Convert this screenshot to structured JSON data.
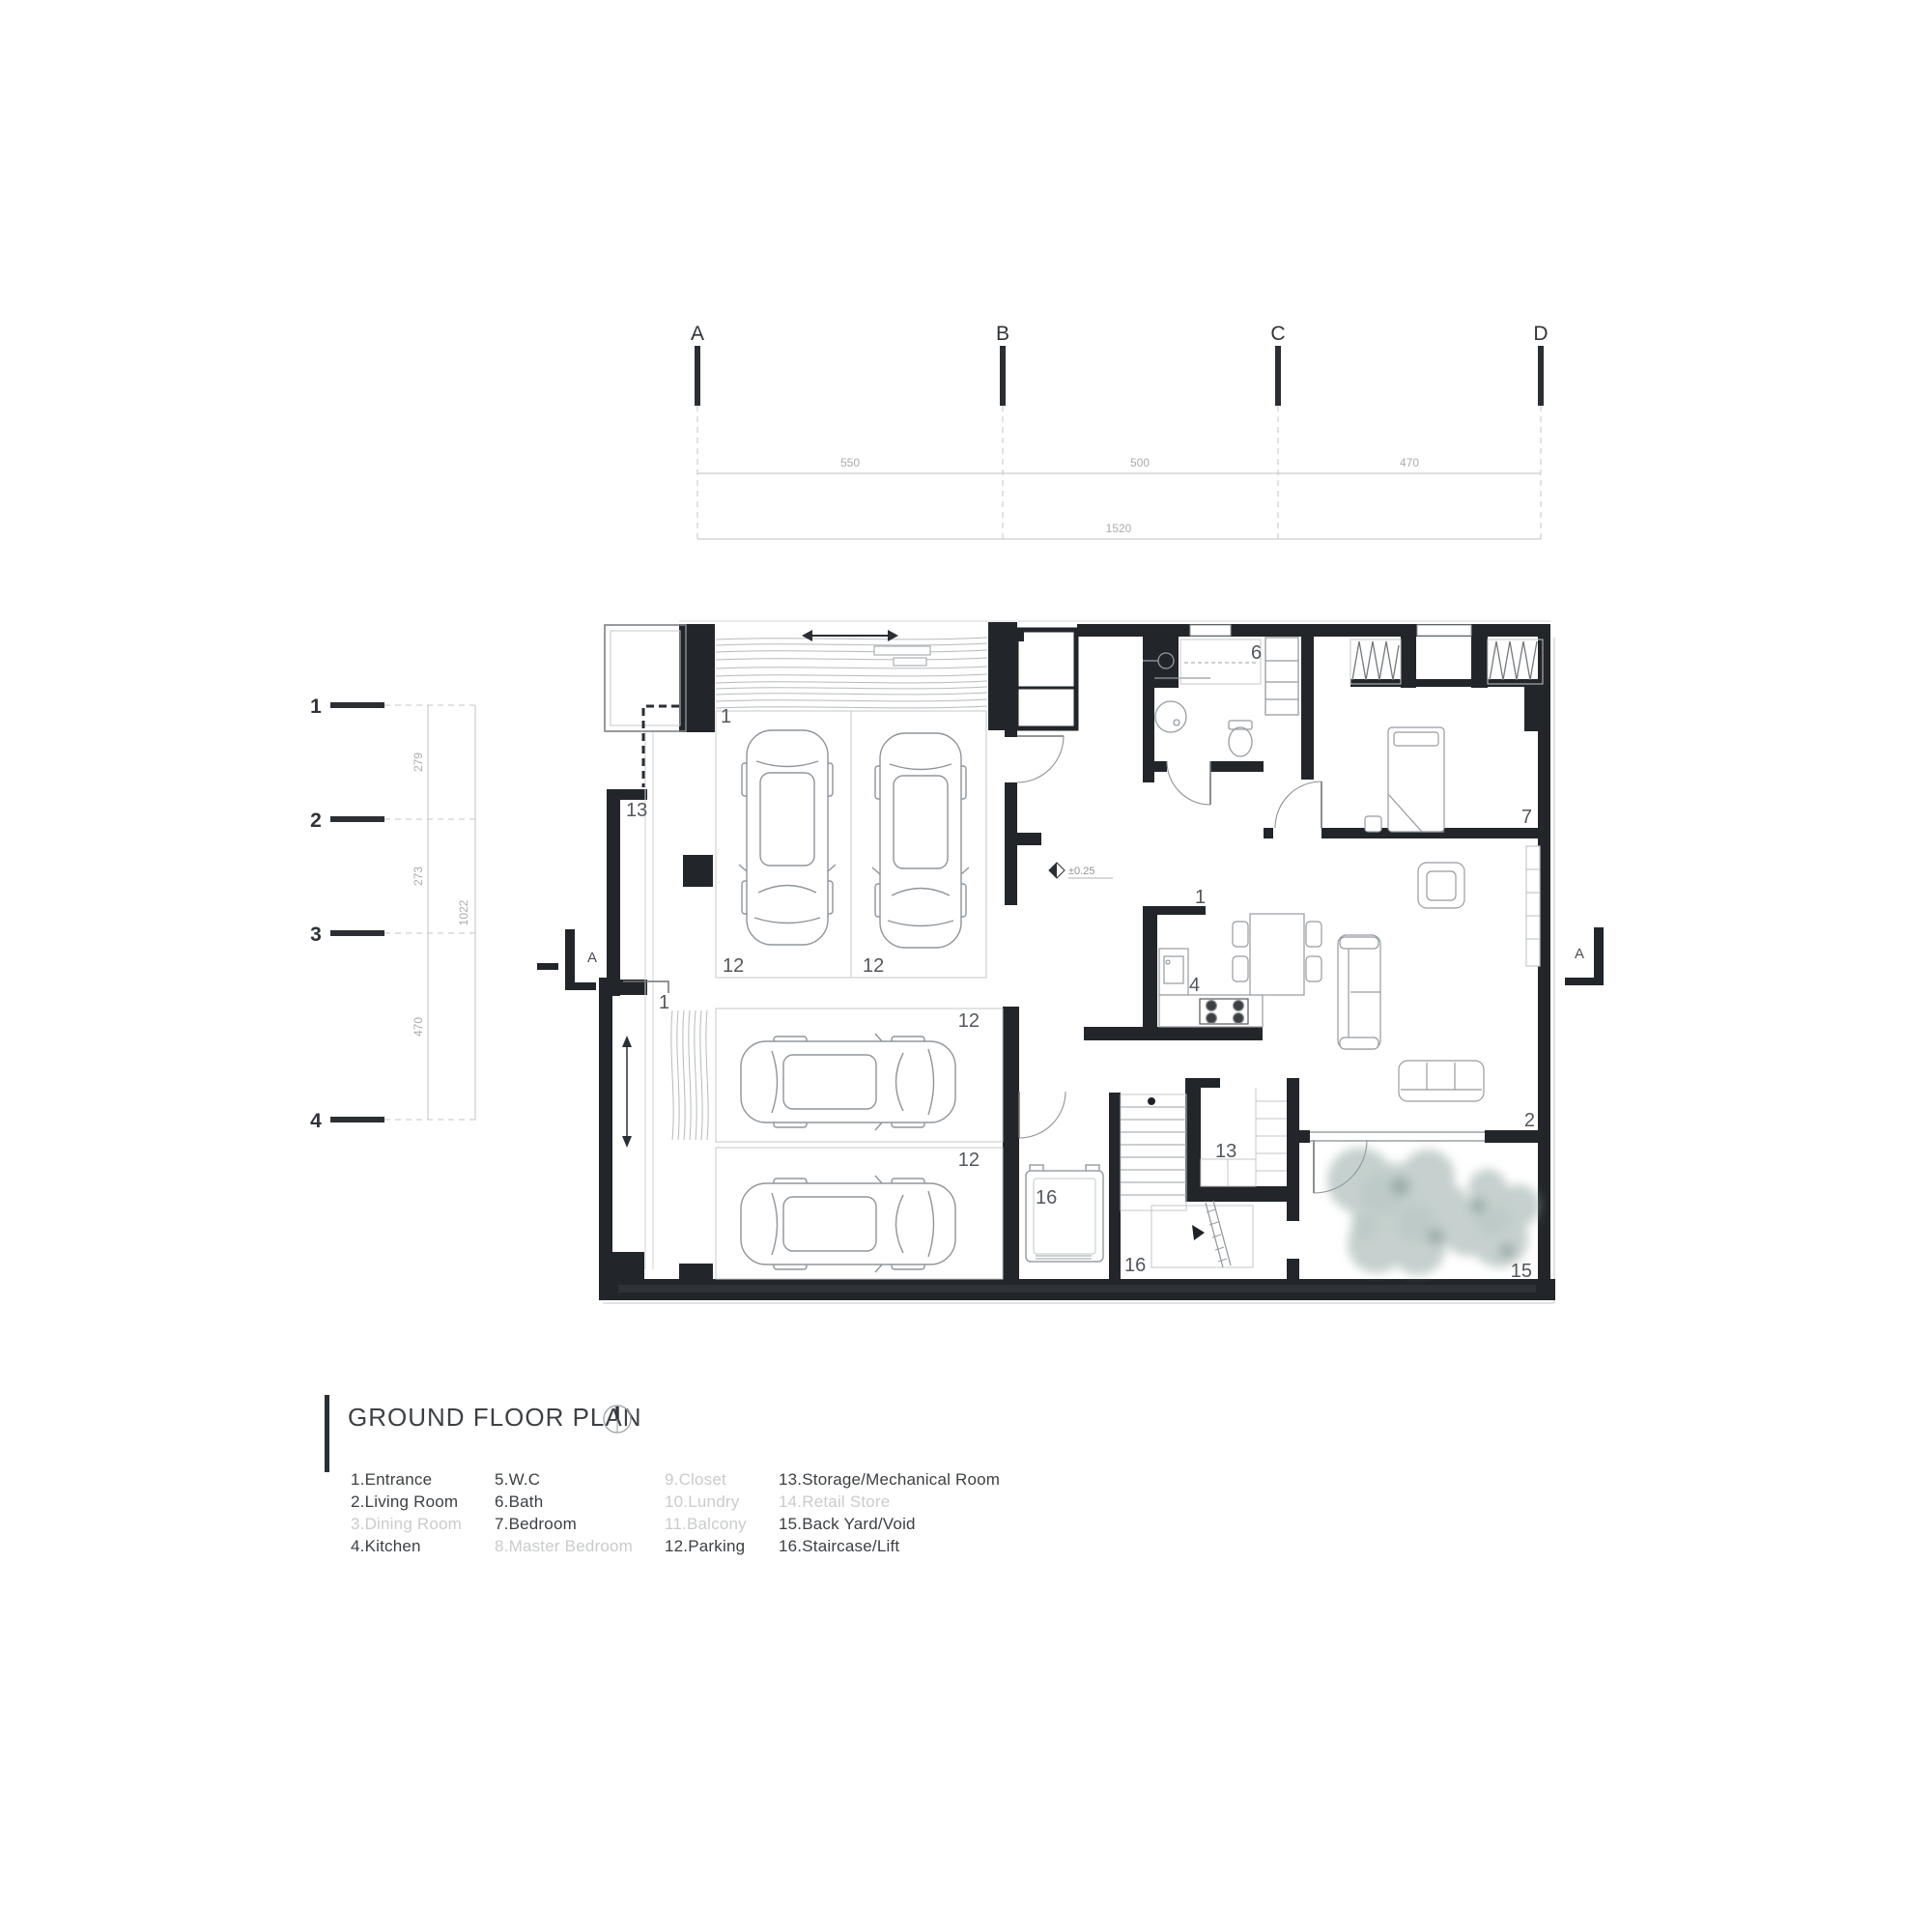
{
  "grid": {
    "columns": [
      {
        "label": "A"
      },
      {
        "label": "B"
      },
      {
        "label": "C"
      },
      {
        "label": "D"
      }
    ],
    "rows": [
      {
        "label": "1"
      },
      {
        "label": "2"
      },
      {
        "label": "3"
      },
      {
        "label": "4"
      }
    ],
    "column_dims": [
      "550",
      "500",
      "470"
    ],
    "column_total": "1520",
    "row_dims": [
      "279",
      "273",
      "470"
    ],
    "row_total": "1022"
  },
  "plan": {
    "level_marker": "±0.25",
    "section_marker_left": "A",
    "section_marker_right": "A",
    "room_labels": [
      {
        "text": "1"
      },
      {
        "text": "12"
      },
      {
        "text": "12"
      },
      {
        "text": "13"
      },
      {
        "text": "1"
      },
      {
        "text": "12"
      },
      {
        "text": "12"
      },
      {
        "text": "6"
      },
      {
        "text": "7"
      },
      {
        "text": "1"
      },
      {
        "text": "4"
      },
      {
        "text": "16"
      },
      {
        "text": "13"
      },
      {
        "text": "16"
      },
      {
        "text": "2"
      },
      {
        "text": "15"
      }
    ]
  },
  "title_block": {
    "title": "GROUND FLOOR PLAN"
  },
  "legend": {
    "items": [
      {
        "label": "1.Entrance",
        "present": true
      },
      {
        "label": "2.Living Room",
        "present": true
      },
      {
        "label": "3.Dining Room",
        "present": false
      },
      {
        "label": "4.Kitchen",
        "present": true
      },
      {
        "label": "5.W.C",
        "present": true
      },
      {
        "label": "6.Bath",
        "present": true
      },
      {
        "label": "7.Bedroom",
        "present": true
      },
      {
        "label": "8.Master Bedroom",
        "present": false
      },
      {
        "label": "9.Closet",
        "present": false
      },
      {
        "label": "10.Lundry",
        "present": false
      },
      {
        "label": "11.Balcony",
        "present": false
      },
      {
        "label": "12.Parking",
        "present": true
      },
      {
        "label": "13.Storage/Mechanical Room",
        "present": true
      },
      {
        "label": "14.Retail Store",
        "present": false
      },
      {
        "label": "15.Back Yard/Void",
        "present": true
      },
      {
        "label": "16.Staircase/Lift",
        "present": true
      }
    ]
  },
  "colors": {
    "wall": "#22262b",
    "thin_line": "#b9bdc1",
    "furniture": "#969ba0",
    "dim_text": "#aeb2b6",
    "dark_text": "#3d4145",
    "muted_legend": "#c9cbcd",
    "tree": "#8ea29e"
  }
}
